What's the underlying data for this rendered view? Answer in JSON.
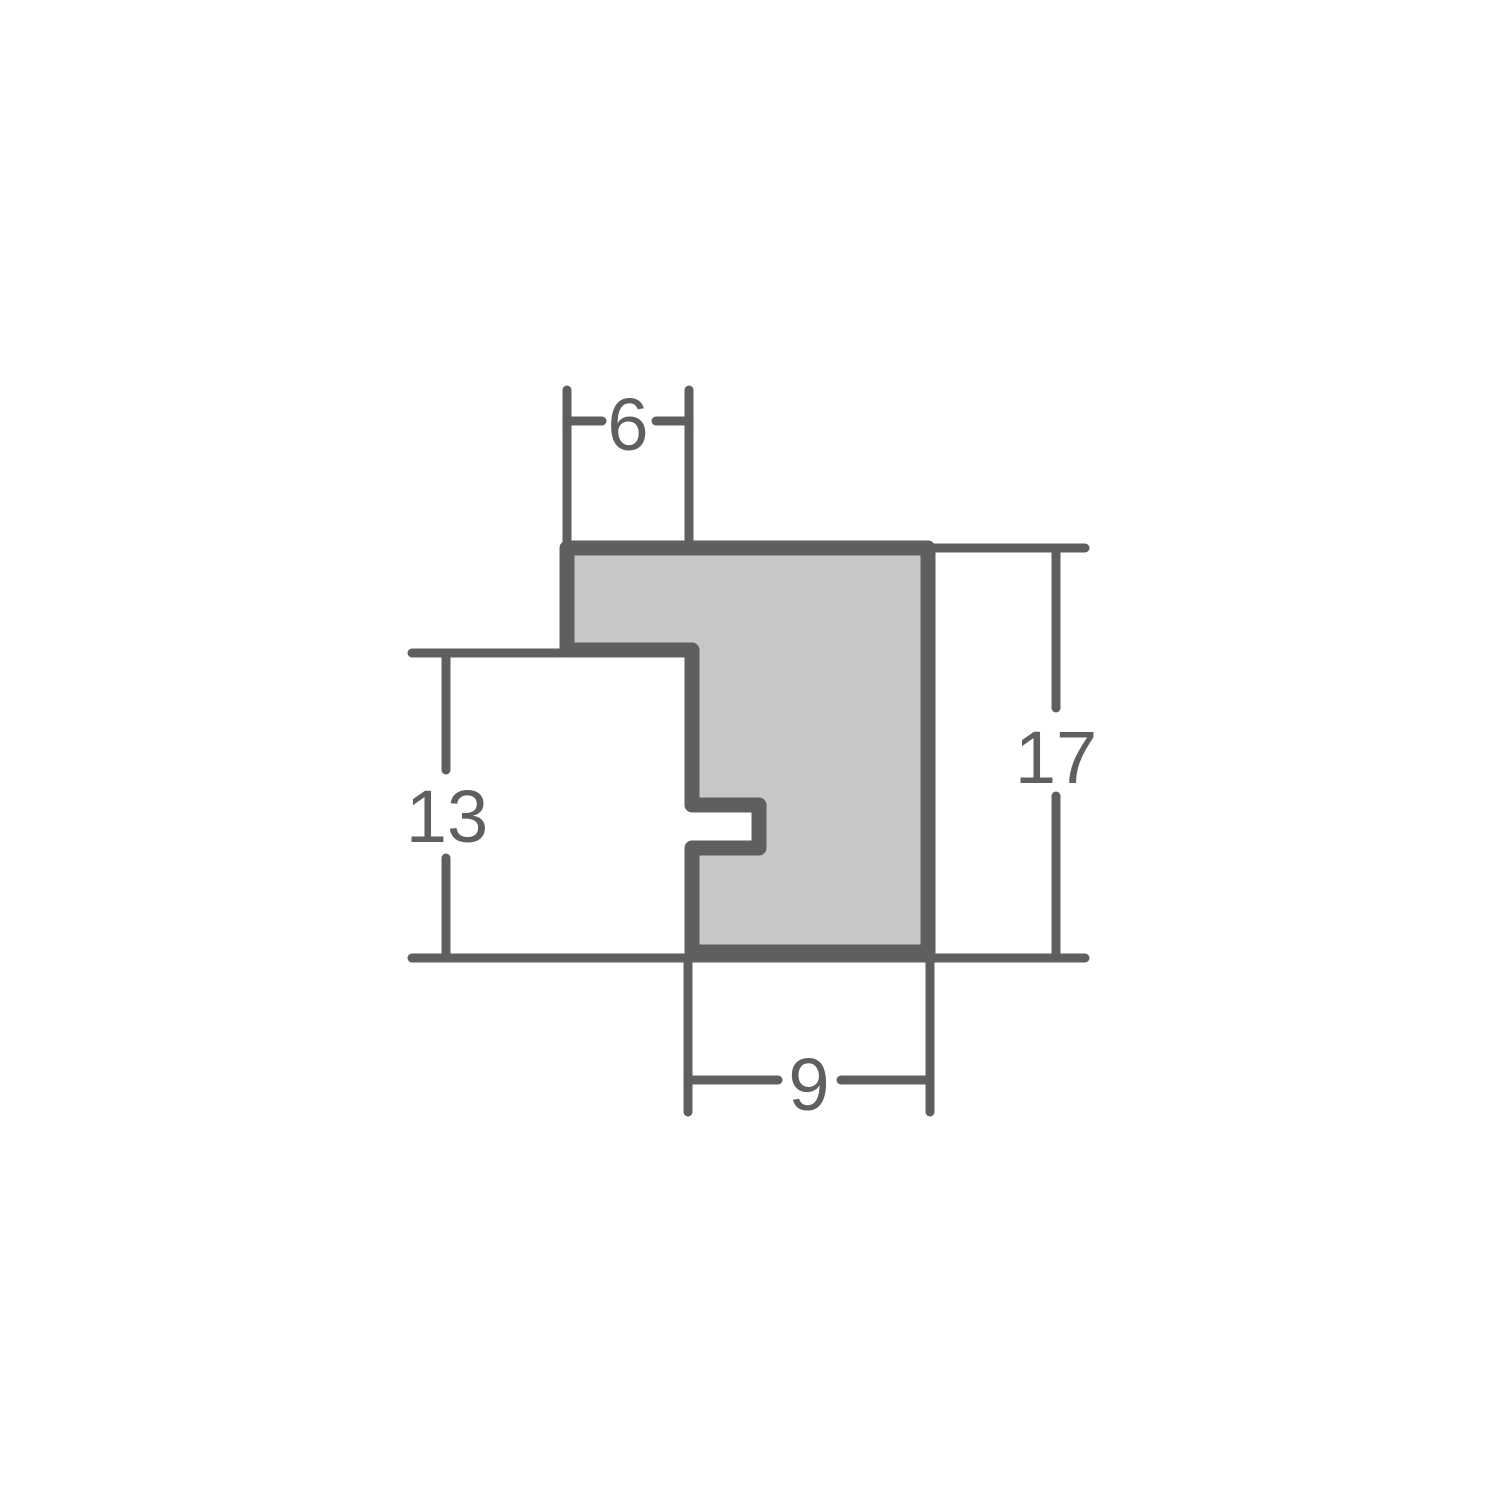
{
  "diagram": {
    "name": "frame-moulding-cross-section",
    "description": "Technical cross-section profile drawing of a picture frame moulding with dimension callouts",
    "colors": {
      "background": "#ffffff",
      "line": "#5f5f5f",
      "profile_fill": "#c7c7c7"
    },
    "dimensions": {
      "top_width": "6",
      "left_height": "13",
      "right_height": "17",
      "bottom_width": "9"
    }
  }
}
